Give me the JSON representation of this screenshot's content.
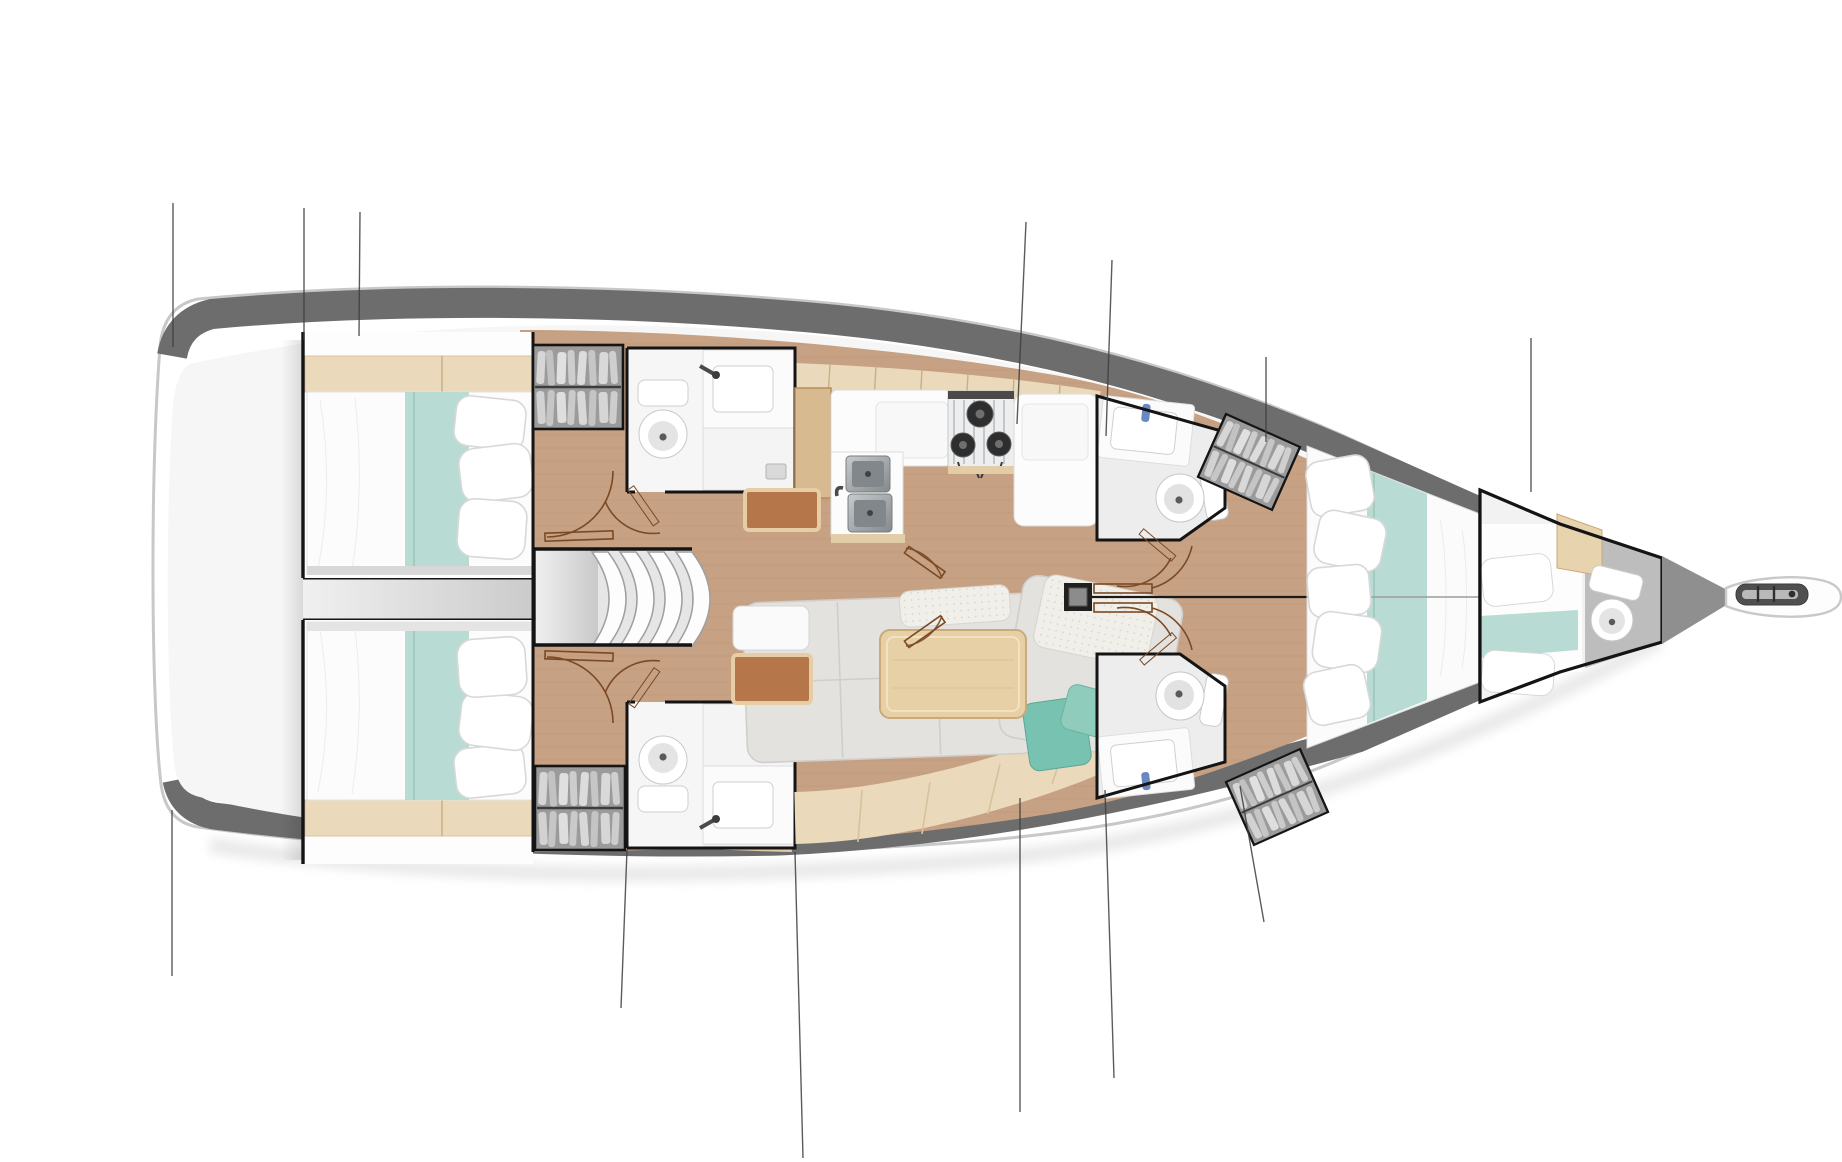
{
  "title": "Sailing yacht interior deck plan (top view, bow to the right)",
  "diagram": {
    "type": "floor-plan",
    "subject": "monohull-sailing-yacht-interior",
    "orientation": "bow-right-stern-left",
    "annotation_lines_visible": 13,
    "text_labels_visible": 0
  },
  "colors": {
    "wood": "#c7a183",
    "woodlight": "#ead9bb",
    "woodmid": "#d8ba90",
    "woodtrim": "#e2cda8",
    "teal": "#b8dcd3",
    "tealdeep": "#77c2b0",
    "band": "#6d6d6d",
    "wall": "#141414",
    "door": "#7a4a26",
    "fixture": "#fbfbfb",
    "corr": "#d9d9d9",
    "steel": "#9aa0a3"
  },
  "rooms": [
    {
      "name": "transom-platform",
      "position": "stern-left",
      "fixtures": [
        "open deck / swim platform area"
      ]
    },
    {
      "name": "aft-cabin-port",
      "position": "aft-top",
      "fixtures": [
        "double bed with teal runner",
        "pillows",
        "headboard cabinetry",
        "hanging locker",
        "door"
      ]
    },
    {
      "name": "aft-cabin-starboard",
      "position": "aft-bottom",
      "fixtures": [
        "double bed with teal runner",
        "pillows",
        "headboard cabinetry",
        "hanging locker",
        "door"
      ]
    },
    {
      "name": "companionway-stairs",
      "position": "center-left",
      "fixtures": [
        "four curved steps",
        "landing"
      ]
    },
    {
      "name": "aft-head-port",
      "position": "top-left-of-galley",
      "fixtures": [
        "toilet",
        "washbasin",
        "shower pan",
        "door"
      ]
    },
    {
      "name": "aft-head-starboard",
      "position": "bottom",
      "fixtures": [
        "toilet",
        "washbasin",
        "shower pan",
        "door"
      ]
    },
    {
      "name": "galley",
      "position": "top-center",
      "fixtures": [
        "double stainless sink",
        "three-burner stove",
        "counters",
        "tall cabinet"
      ]
    },
    {
      "name": "salon",
      "position": "bottom-center",
      "fixtures": [
        "L-shaped settee",
        "wooden table",
        "teal cushions",
        "bench",
        "floor mats"
      ]
    },
    {
      "name": "fwd-head-port",
      "position": "top-right-of-mast",
      "fixtures": [
        "washbasin",
        "toilet",
        "door",
        "hanging locker"
      ]
    },
    {
      "name": "fwd-head-starboard",
      "position": "bottom-right-of-mast",
      "fixtures": [
        "washbasin",
        "toilet",
        "door",
        "hanging locker"
      ]
    },
    {
      "name": "forward-cabin",
      "position": "bow-center",
      "fixtures": [
        "V-double bed with teal runner",
        "pillows"
      ]
    },
    {
      "name": "bow-cabin",
      "position": "far-bow",
      "fixtures": [
        "single berth",
        "toilet",
        "teal blanket"
      ]
    },
    {
      "name": "mast-post",
      "position": "center",
      "fixtures": [
        "mast column",
        "double doors"
      ]
    },
    {
      "name": "bowsprit",
      "position": "far-right",
      "fixtures": [
        "anchor roller"
      ]
    }
  ]
}
